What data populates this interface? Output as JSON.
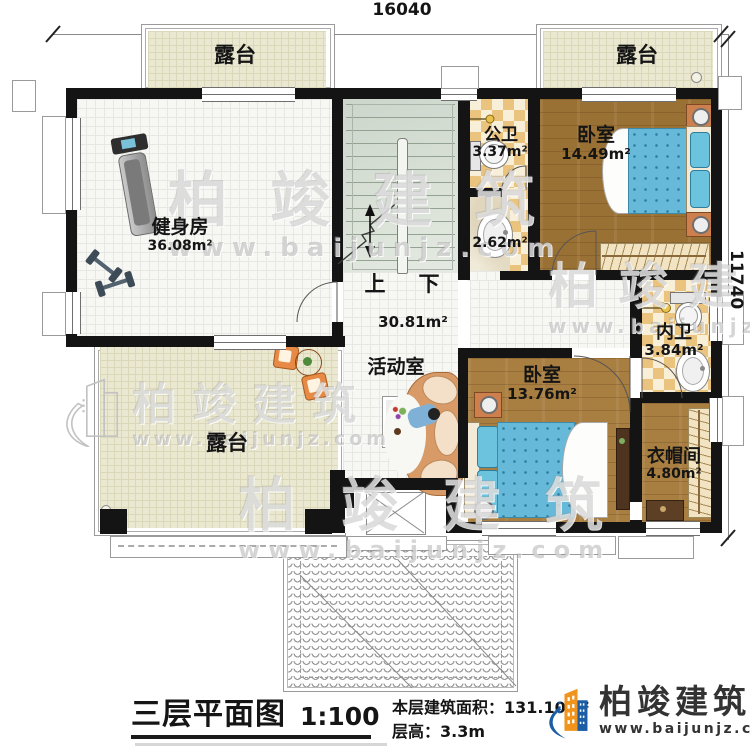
{
  "dimensions": {
    "top": "16040",
    "right": "11740"
  },
  "rooms": {
    "terrace_tl": {
      "name": "露台"
    },
    "terrace_tr": {
      "name": "露台"
    },
    "terrace_bl": {
      "name": "露台"
    },
    "gym": {
      "name": "健身房",
      "area": "36.08m²"
    },
    "public_bath": {
      "name": "公卫",
      "area": "3.37m²"
    },
    "vestibule": {
      "area": "2.62m²"
    },
    "bedroom_ne": {
      "name": "卧室",
      "area": "14.49m²"
    },
    "inner_bath": {
      "name": "内卫",
      "area": "3.84m²"
    },
    "bedroom_s": {
      "name": "卧室",
      "area": "13.76m²"
    },
    "cloakroom": {
      "name": "衣帽间",
      "area": "4.80m²"
    },
    "activity": {
      "name": "活动室",
      "area": "30.81m²"
    }
  },
  "stairs": {
    "up": "上",
    "down": "下"
  },
  "title_block": {
    "title": "三层平面图",
    "scale": "1:100",
    "area_label": "本层建筑面积：",
    "area_value": "131.10m²",
    "height_label": "层高：",
    "height_value": "3.3m"
  },
  "logo": {
    "brand": "柏竣建筑",
    "site": "www.baijunjz.com"
  },
  "watermark": {
    "brand": "柏竣建筑",
    "site": "www.baijunjz.com"
  },
  "colors": {
    "wood_floor": "#a87e41",
    "checker_tile": "#eac47f",
    "terrace_tile": "#ebe8d2",
    "bed_blue": "#63b9d9",
    "logo_blue": "#1b5ea6",
    "logo_orange": "#f0941d"
  }
}
